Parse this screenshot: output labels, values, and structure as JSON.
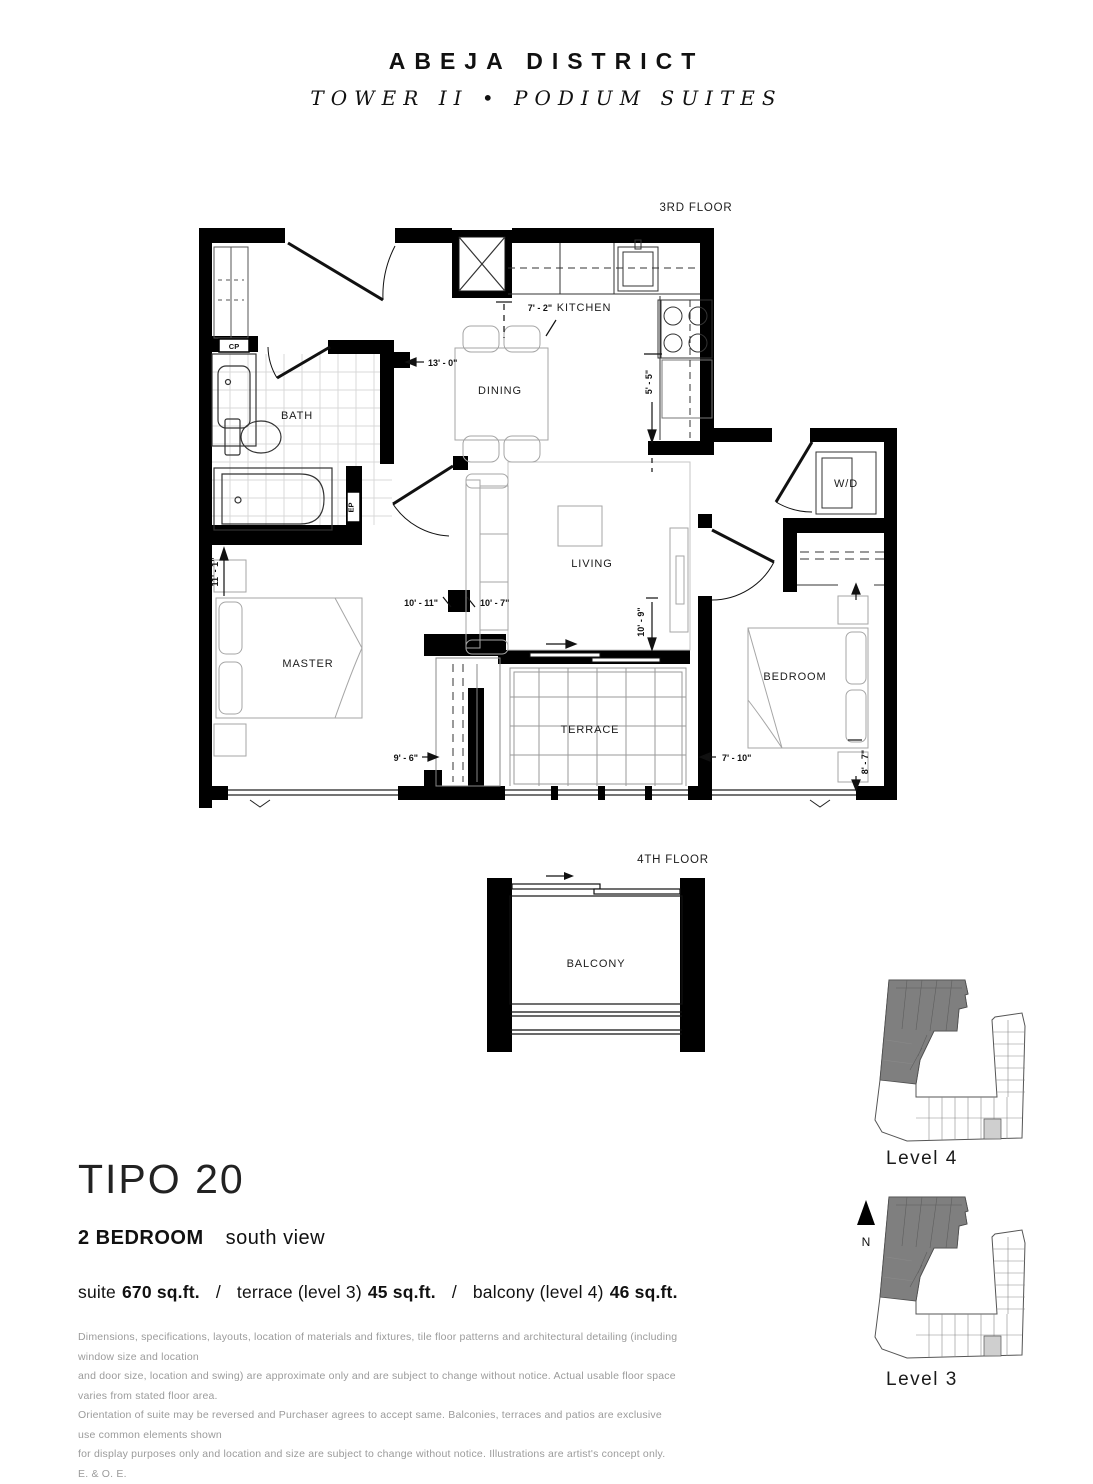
{
  "header": {
    "brand": "ABEJA DISTRICT",
    "subbrand": "TOWER II • PODIUM SUITES"
  },
  "floorplan": {
    "floor_label": "3RD FLOOR",
    "rooms": {
      "kitchen": "KITCHEN",
      "dining": "DINING",
      "bath": "BATH",
      "living": "LIVING",
      "master": "MASTER",
      "bedroom": "BEDROOM",
      "terrace": "TERRACE",
      "wd": "W/D"
    },
    "dimensions": {
      "kitchen_width": "7' - 2\"",
      "hall": "13' - 0\"",
      "kitchen_depth": "5' - 5\"",
      "master_depth": "11' - 1\"",
      "master_width": "10' - 11\"",
      "living_width": "10' - 7\"",
      "living_depth": "10' - 9\"",
      "master_width_b": "9' - 6\"",
      "bedroom_width": "7' - 10\"",
      "bedroom_depth": "8' - 7\""
    },
    "tags": {
      "cp": "CP",
      "ep": "EP"
    }
  },
  "balcony_plan": {
    "floor_label": "4TH FLOOR",
    "room": "BALCONY"
  },
  "keyplan": {
    "level4": "Level 4",
    "level3": "Level 3",
    "north": "N"
  },
  "suite": {
    "name": "TIPO 20",
    "type": "2 BEDROOM",
    "view": "south view",
    "separator": "/",
    "areas": [
      {
        "label": "suite",
        "value": "670 sq.ft."
      },
      {
        "label": "terrace (level 3)",
        "value": "45 sq.ft."
      },
      {
        "label": "balcony (level 4)",
        "value": "46 sq.ft."
      }
    ]
  },
  "disclaimer": {
    "lines": [
      "Dimensions, specifications, layouts, location of materials and fixtures, tile floor patterns and architectural detailing (including window size and location",
      "and door size, location and swing) are approximate only and are subject to change without notice. Actual usable floor space varies from stated floor area.",
      "Orientation of suite may be reversed and Purchaser agrees to accept same. Balconies, terraces and patios are exclusive use common elements shown",
      "for display purposes only and location and size are subject to change without notice. Illustrations are artist's concept only. E. & O. E."
    ]
  }
}
